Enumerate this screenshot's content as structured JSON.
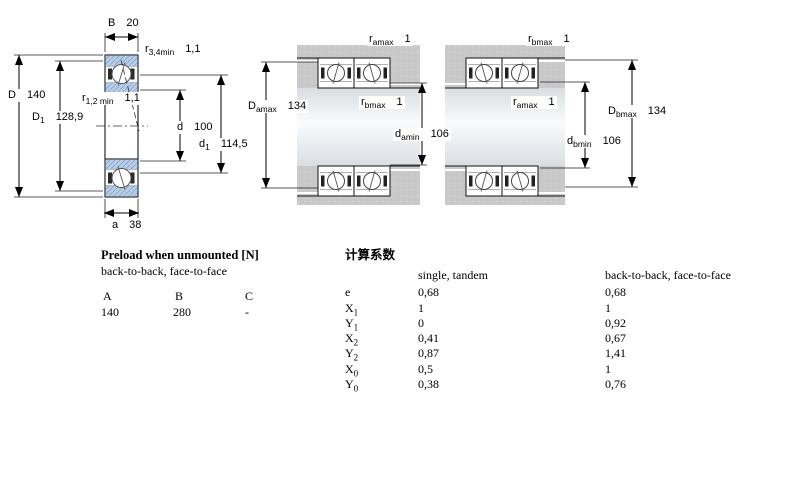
{
  "diagram_labels": {
    "B": {
      "base": "B",
      "sub": "",
      "value": "20"
    },
    "r34": {
      "base": "r",
      "sub": "3,4min",
      "value": "1,1"
    },
    "D": {
      "base": "D",
      "sub": "",
      "value": "140"
    },
    "D1": {
      "base": "D",
      "sub": "1",
      "value": "128,9"
    },
    "r12": {
      "base": "r",
      "sub": "1,2 min",
      "value": "1,1"
    },
    "d": {
      "base": "d",
      "sub": "",
      "value": "100"
    },
    "d1": {
      "base": "d",
      "sub": "1",
      "value": "114,5"
    },
    "a": {
      "base": "a",
      "sub": "",
      "value": "38"
    },
    "m_ra": {
      "base": "r",
      "sub": "amax",
      "value": "1"
    },
    "m_Da": {
      "base": "D",
      "sub": "amax",
      "value": "134"
    },
    "m_rb": {
      "base": "r",
      "sub": "bmax",
      "value": "1"
    },
    "m_da": {
      "base": "d",
      "sub": "amin",
      "value": "106"
    },
    "rt_rb": {
      "base": "r",
      "sub": "bmax",
      "value": "1"
    },
    "rt_ra": {
      "base": "r",
      "sub": "amax",
      "value": "1"
    },
    "rt_db": {
      "base": "d",
      "sub": "bmin",
      "value": "106"
    },
    "rt_Db": {
      "base": "D",
      "sub": "bmax",
      "value": "134"
    }
  },
  "preload": {
    "title": "Preload when unmounted [N]",
    "subtitle": "back-to-back, face-to-face",
    "columns": [
      "A",
      "B",
      "C"
    ],
    "values": [
      "140",
      "280",
      "-"
    ]
  },
  "factors": {
    "title": "计算系数",
    "col1_header": "single, tandem",
    "col2_header": "back-to-back, face-to-face",
    "rows": [
      {
        "base": "e",
        "sub": "",
        "v1": "0,68",
        "v2": "0,68"
      },
      {
        "base": "X",
        "sub": "1",
        "v1": "1",
        "v2": "1"
      },
      {
        "base": "Y",
        "sub": "1",
        "v1": "0",
        "v2": "0,92"
      },
      {
        "base": "X",
        "sub": "2",
        "v1": "0,41",
        "v2": "0,67"
      },
      {
        "base": "Y",
        "sub": "2",
        "v1": "0,87",
        "v2": "1,41"
      },
      {
        "base": "X",
        "sub": "0",
        "v1": "0,5",
        "v2": "1"
      },
      {
        "base": "Y",
        "sub": "0",
        "v1": "0,38",
        "v2": "0,76"
      }
    ]
  },
  "colors": {
    "ring_blue": "#b9cde6",
    "housing_gray": "#c9c9c9",
    "line": "#1a1a1a"
  }
}
